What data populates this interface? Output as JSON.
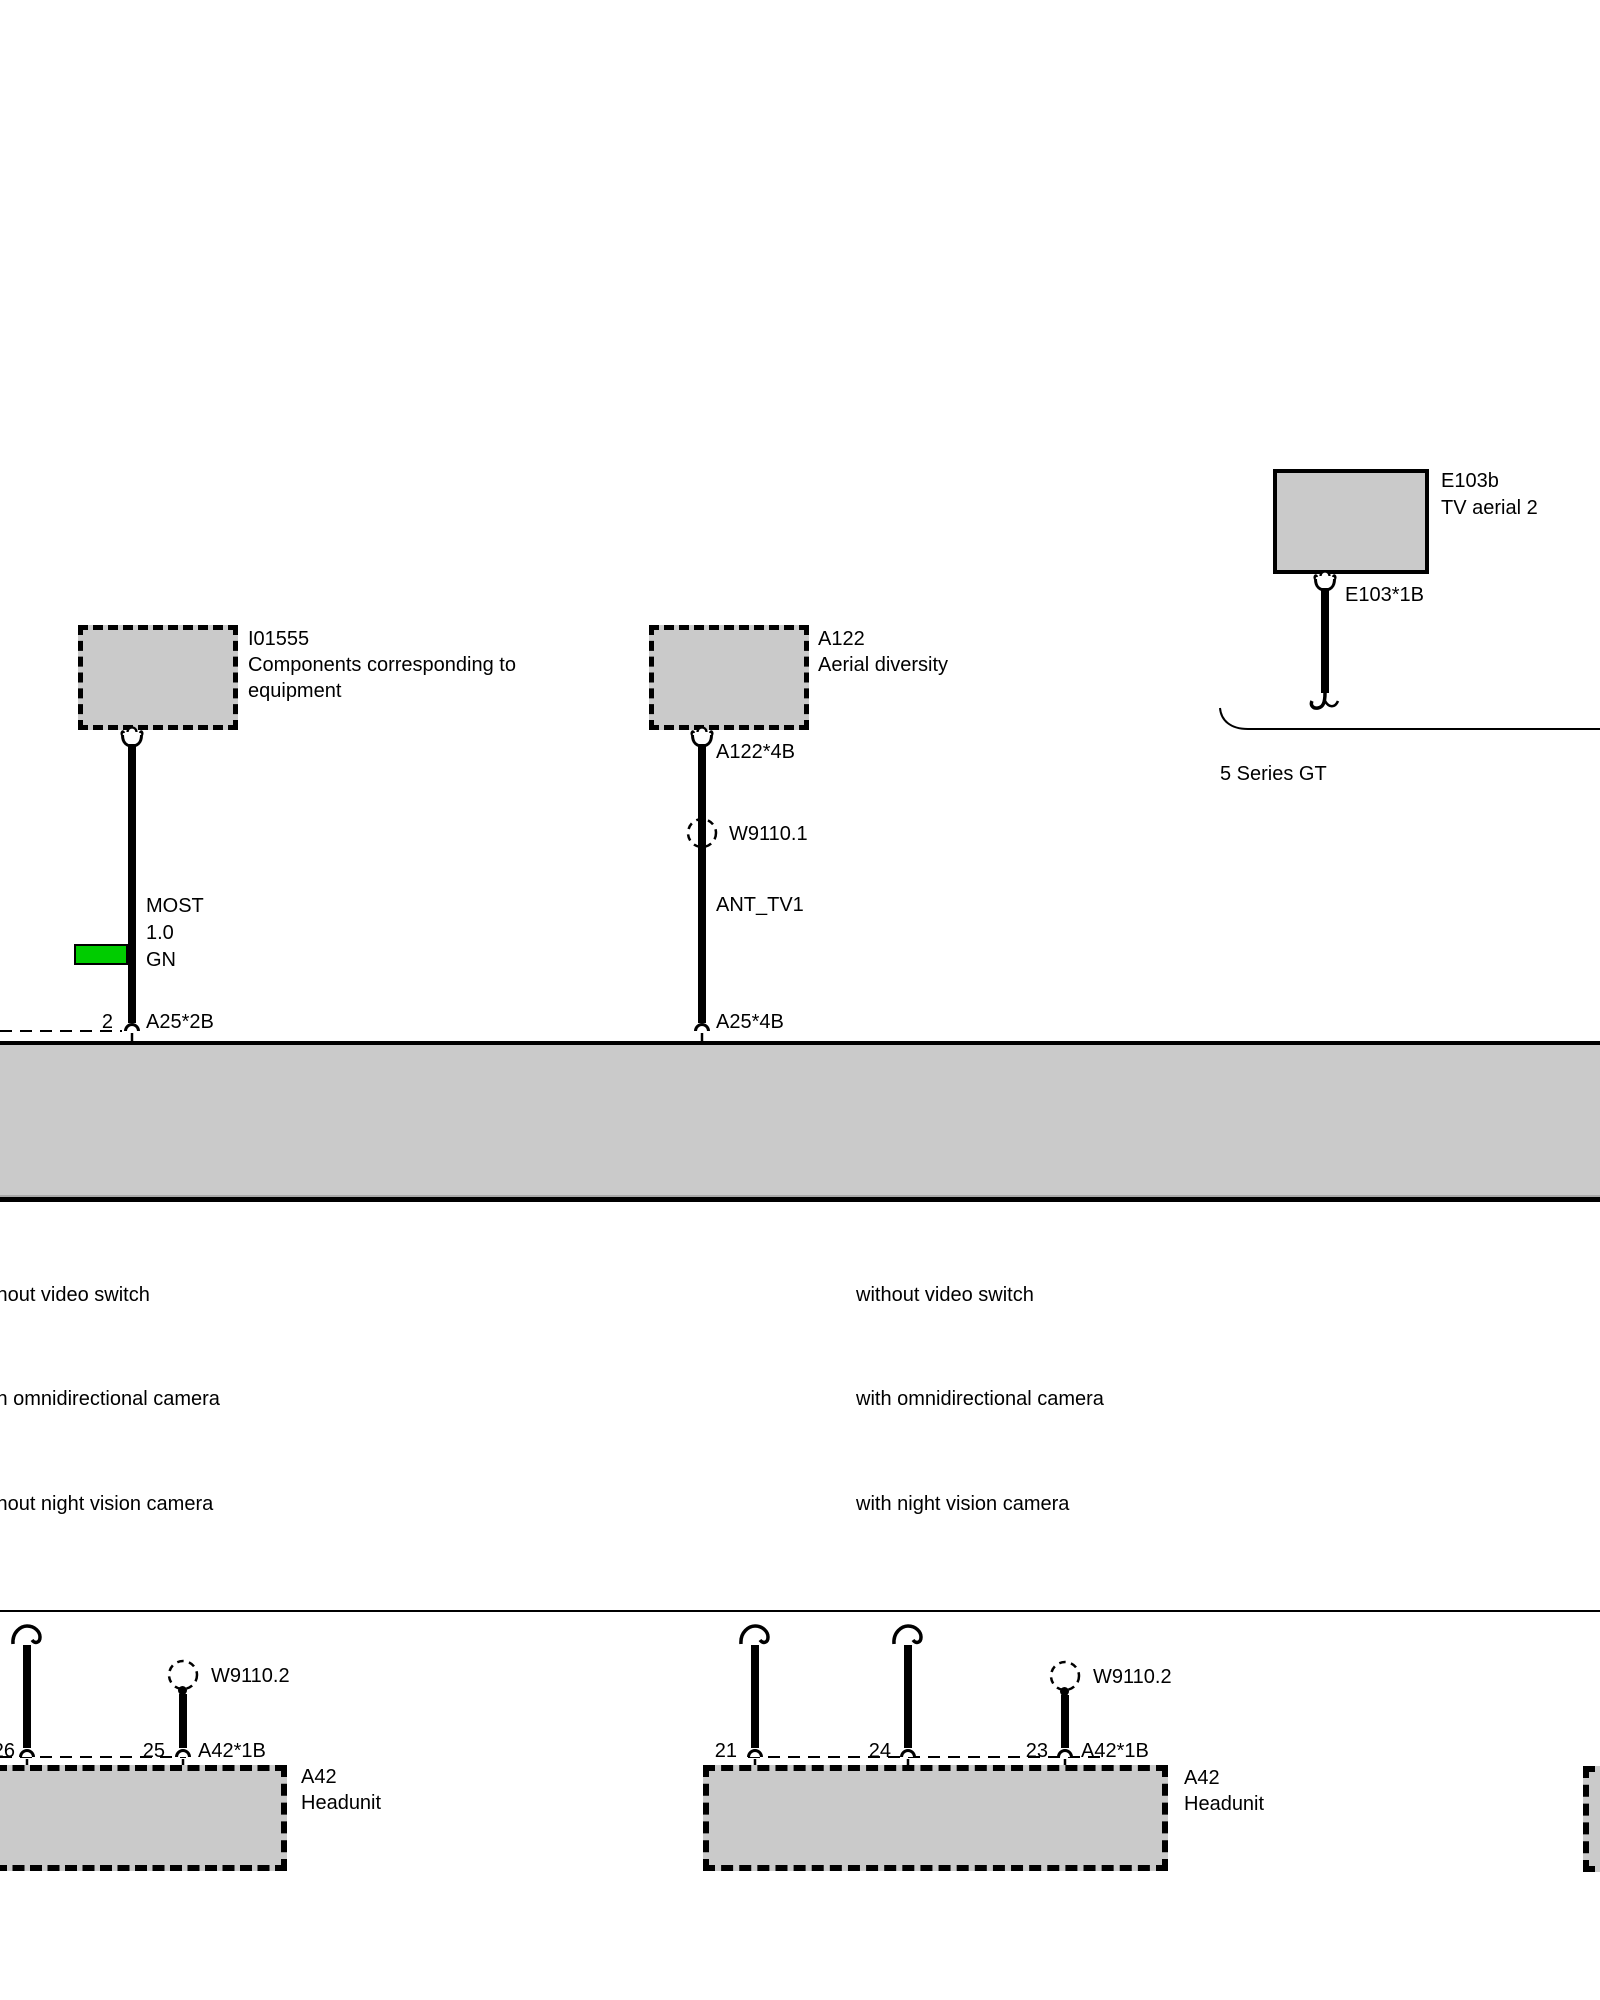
{
  "comp": {
    "e103b": {
      "id": "E103b",
      "name": "TV aerial 2",
      "connector": "E103*1B"
    },
    "i01555": {
      "id": "I01555",
      "desc": [
        "Components corresponding to",
        "equipment"
      ]
    },
    "a122": {
      "id": "A122",
      "name": "Aerial diversity",
      "connector": "A122*4B"
    }
  },
  "note": {
    "vehicle": "5 Series GT"
  },
  "splice": {
    "w1": "W9110.1",
    "w2": "W9110.2"
  },
  "wire": {
    "most": {
      "bus": "MOST",
      "gauge": "1.0",
      "color": "GN",
      "pin": "2",
      "connector": "A25*2B"
    },
    "ant": {
      "signal": "ANT_TV1",
      "connector": "A25*4B"
    }
  },
  "options": {
    "left": [
      "without video switch",
      "with omnidirectional camera",
      "without night vision camera"
    ],
    "right": [
      "without video switch",
      "with omnidirectional camera",
      "with night vision camera"
    ]
  },
  "headunit": {
    "id": "A42",
    "name": "Headunit",
    "conn": "A42*1B",
    "pins_left": [
      "26",
      "25"
    ],
    "pins_mid": [
      "21",
      "24",
      "23"
    ]
  },
  "colors": {
    "wire_green": "#00cc00",
    "fill_gray": "#cacaca"
  }
}
